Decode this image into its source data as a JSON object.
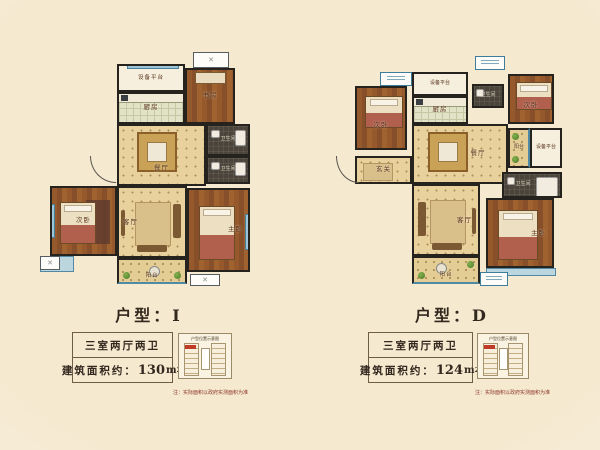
{
  "page": {
    "background": "#f5e9d0",
    "wall_color": "#26231f",
    "accent_window_blue": "#3e7d99",
    "note_color": "#8a3428"
  },
  "plan_i": {
    "title": "户型：I",
    "rooms": {
      "equip": "设备平台",
      "kitchen": "厨房",
      "study": "书房",
      "bath1": "卫生间",
      "bath2": "卫生间",
      "dining": "餐厅",
      "living": "客厅",
      "bed2": "次卧",
      "master": "主卧",
      "balcony": "阳台"
    },
    "info": {
      "layout": "三室两厅两卫",
      "area_label": "建筑面积约：",
      "area_value": "130",
      "area_unit": "m",
      "area_sup": "2"
    },
    "keyplan_title": "户型位置示意图",
    "note": "注：实际面积以政府实测面积为准"
  },
  "plan_d": {
    "title": "户型：D",
    "rooms": {
      "bed2": "次卧",
      "equip_top": "设备平台",
      "kitchen": "厨房",
      "bath_top": "卫生间",
      "bed3": "次卧",
      "balcony_right": "阳台",
      "equip_right": "设备平台",
      "dining": "餐厅",
      "hall": "玄关",
      "living": "客厅",
      "bath_master": "卫生间",
      "master": "主卧",
      "balcony": "阳台"
    },
    "info": {
      "layout": "三室两厅两卫",
      "area_label": "建筑面积约：",
      "area_value": "124",
      "area_unit": "m",
      "area_sup": "2"
    },
    "keyplan_title": "户型位置示意图",
    "note": "注：实际面积以政府实测面积为准"
  }
}
